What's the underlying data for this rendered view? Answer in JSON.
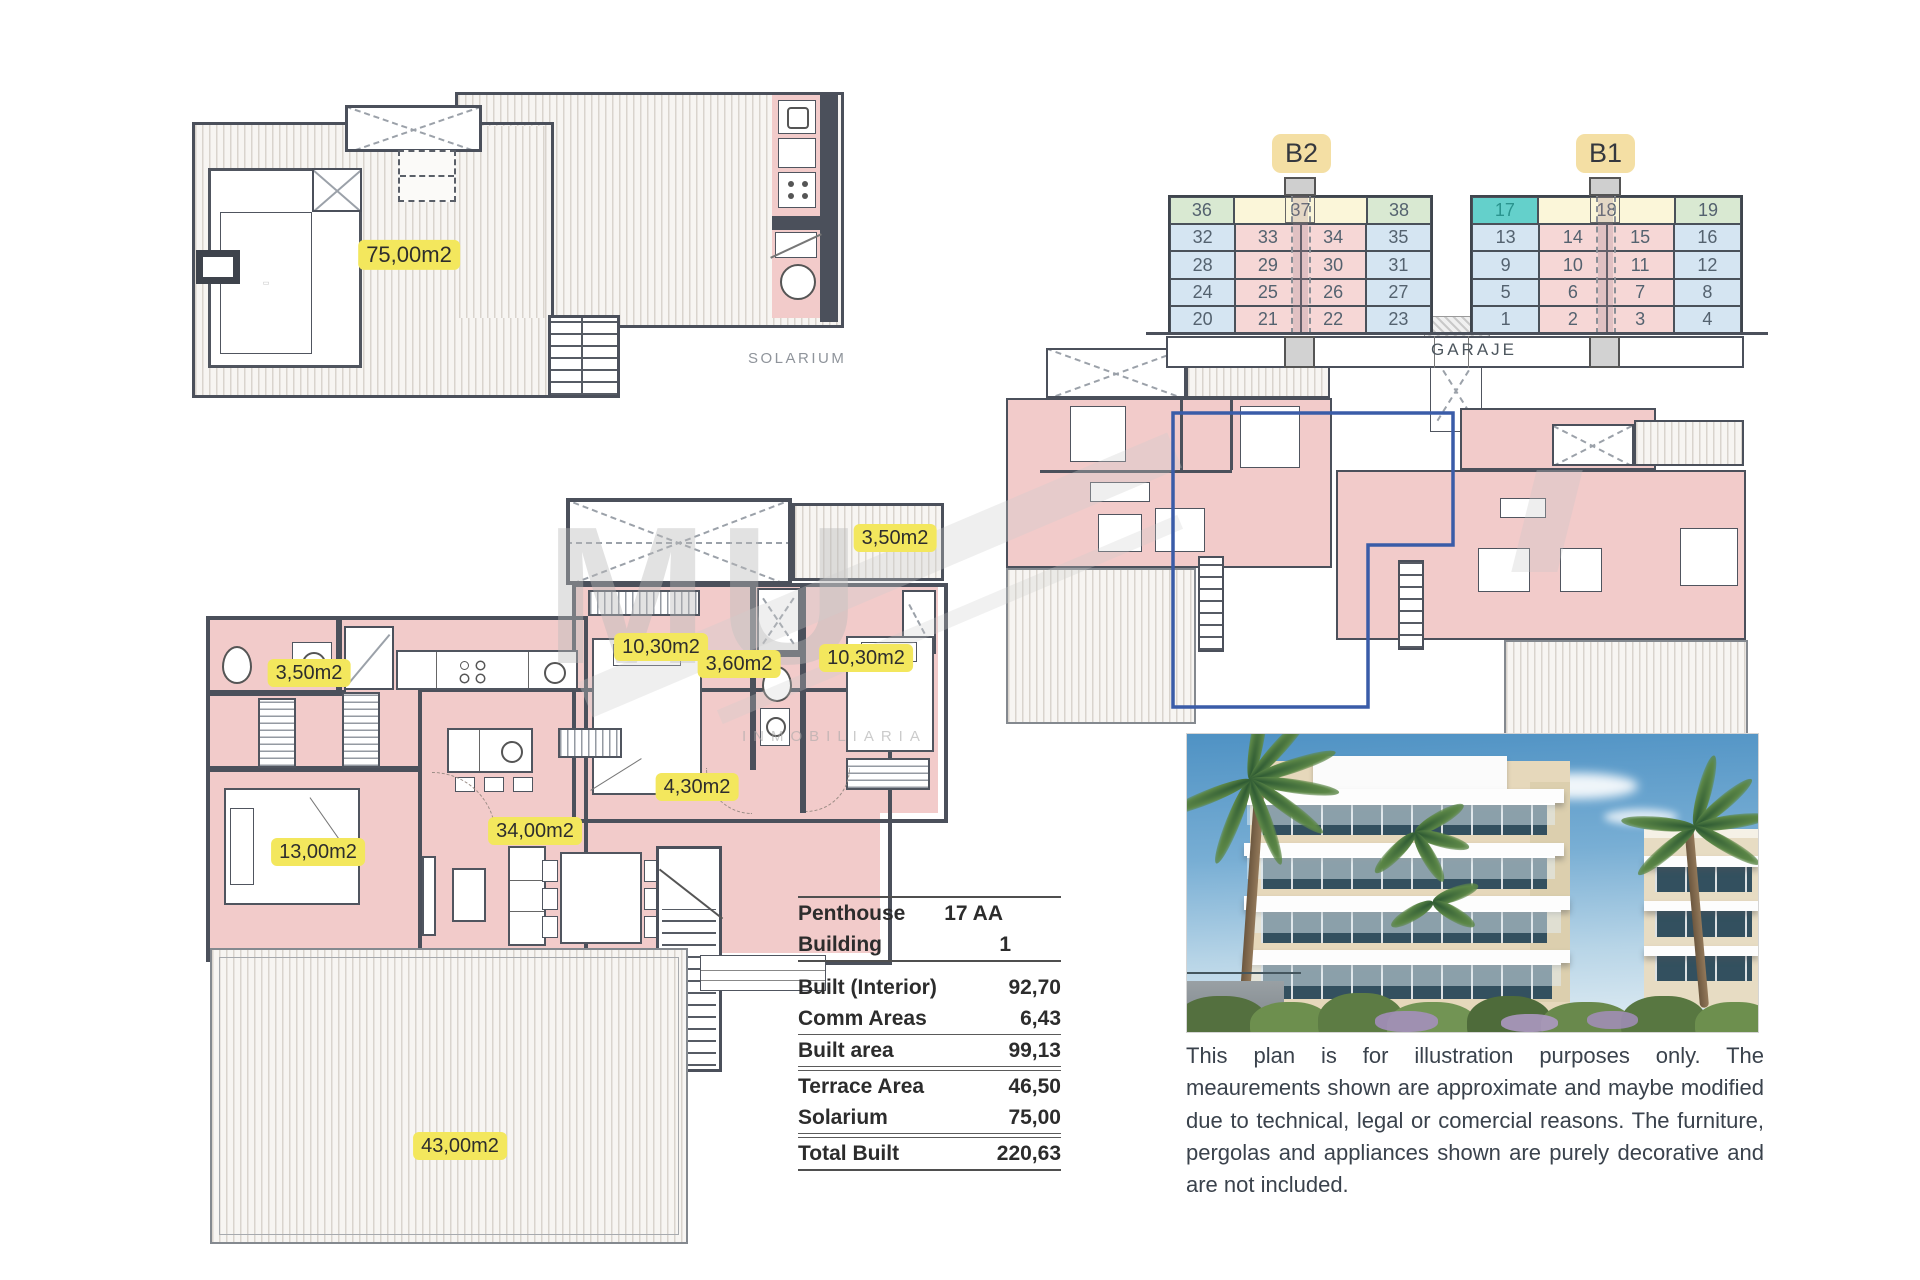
{
  "labels": {
    "solarium_area": "75,00m2",
    "solarium_caption": "SOLARIUM",
    "terrace_top": "3,50m2",
    "bedroom_left": "10,30m2",
    "bath_mid": "3,60m2",
    "bedroom_right": "10,30m2",
    "hall": "4,30m2",
    "living": "34,00m2",
    "bedroom_lower": "13,00m2",
    "bath_left": "3,50m2",
    "terrace_bottom": "43,00m2"
  },
  "watermark": {
    "big": "MU",
    "sub": "INMOBILIARIA"
  },
  "unit_grids": {
    "garage_label": "GARAJE",
    "b2": {
      "label": "B2",
      "top_row": [
        "36",
        "37",
        "38"
      ],
      "top_types": [
        "green",
        "yellow",
        "green"
      ],
      "rows": [
        [
          "32",
          "33",
          "34",
          "35"
        ],
        [
          "28",
          "29",
          "30",
          "31"
        ],
        [
          "24",
          "25",
          "26",
          "27"
        ],
        [
          "20",
          "21",
          "22",
          "23"
        ]
      ]
    },
    "b1": {
      "label": "B1",
      "top_row": [
        "17",
        "18",
        "19"
      ],
      "top_types": [
        "teal",
        "yellow",
        "green"
      ],
      "rows": [
        [
          "13",
          "14",
          "15",
          "16"
        ],
        [
          "9",
          "10",
          "11",
          "12"
        ],
        [
          "5",
          "6",
          "7",
          "8"
        ],
        [
          "1",
          "2",
          "3",
          "4"
        ]
      ],
      "highlighted_unit": "17"
    }
  },
  "area_table": {
    "header": [
      {
        "label": "Penthouse",
        "value": "17 AA"
      },
      {
        "label": "Building",
        "value": "1"
      }
    ],
    "body": [
      {
        "label": "Built (Interior)",
        "value": "92,70"
      },
      {
        "label": "Comm Areas",
        "value": "6,43"
      }
    ],
    "built_area": {
      "label": "Built area",
      "value": "99,13"
    },
    "outdoor": [
      {
        "label": "Terrace Area",
        "value": "46,50"
      },
      {
        "label": "Solarium",
        "value": "75,00"
      }
    ],
    "total": {
      "label": "Total Built",
      "value": "220,63"
    }
  },
  "disclaimer": "This plan is for illustration purposes only. The meaurements shown are approximate and maybe modified due to technical, legal or comercial reasons. The furniture, pergolas and appliances shown are purely decorative and are not included.",
  "colors": {
    "accent_yellow": "#f3e75d",
    "highlight_teal": "#64d0cb",
    "unit_green": "#d9e9d2",
    "unit_blue": "#d5e5f2",
    "unit_pink": "#f6d7d6",
    "unit_core_yellow": "#fbf6d9",
    "room_pink": "#f2cbca",
    "wall_dark": "#4b505b",
    "outline_blue": "#3a5ca8"
  }
}
